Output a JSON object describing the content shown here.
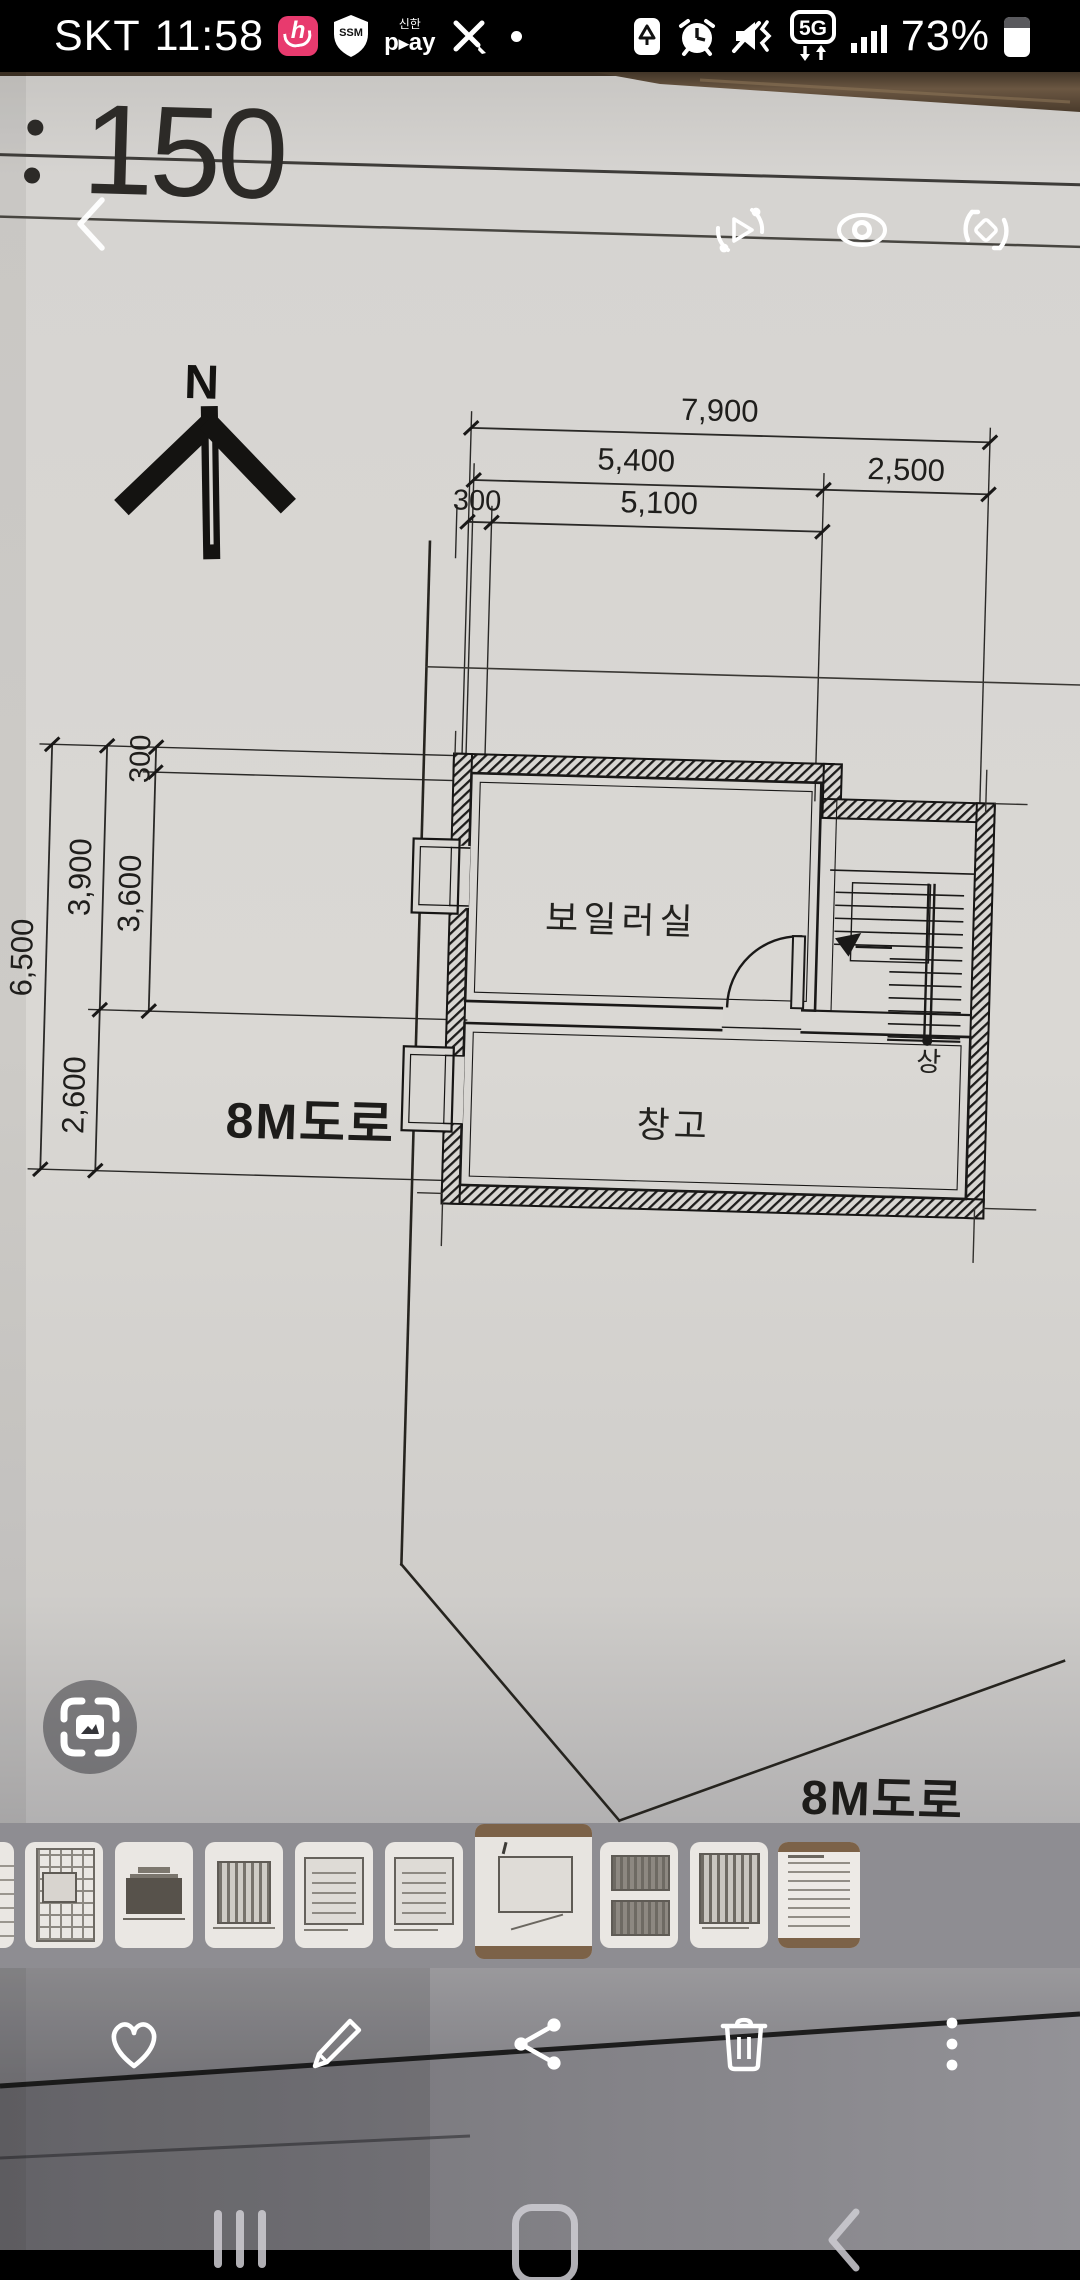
{
  "status_bar": {
    "carrier": "SKT",
    "time": "11:58",
    "battery_percent": "73%",
    "network": "5G",
    "ssm_label": "SSM",
    "shinhan_label": "신한",
    "play_p": "p",
    "play_tri": "▶",
    "play_ay": "ay"
  },
  "viewer": {
    "scale_colon": ":",
    "scale_number": "150"
  },
  "drawing": {
    "north_label": "N",
    "dims": {
      "d7900": "7,900",
      "d5400": "5,400",
      "d2500": "2,500",
      "d300_top": "300",
      "d5100": "5,100",
      "d6500": "6,500",
      "d3900": "3,900",
      "d3600": "3,600",
      "d300_left": "300",
      "d2600": "2,600"
    },
    "rooms": {
      "boiler": "보일러실",
      "storage": "창고",
      "stair_up": "상"
    },
    "roads": {
      "left": "8M도로",
      "bottom": "8M도로"
    }
  },
  "thumbnails": [
    {
      "type": "sliver"
    },
    {
      "type": "detail"
    },
    {
      "type": "elevation"
    },
    {
      "type": "framing"
    },
    {
      "type": "plan"
    },
    {
      "type": "plan"
    },
    {
      "type": "current",
      "current": true
    },
    {
      "type": "sections"
    },
    {
      "type": "section"
    },
    {
      "type": "doc"
    }
  ],
  "action_bar": {
    "icons": [
      "favorite",
      "edit",
      "share",
      "delete",
      "more"
    ]
  },
  "nav_bar": {
    "icons": [
      "recents",
      "home",
      "back"
    ]
  },
  "header": {
    "icons": [
      "motion-photo",
      "eye",
      "rotate"
    ]
  },
  "colors": {
    "accent_pink": "#e83a6e",
    "paper": "#d9d7d3",
    "strip_bg": "#8e8d92"
  }
}
